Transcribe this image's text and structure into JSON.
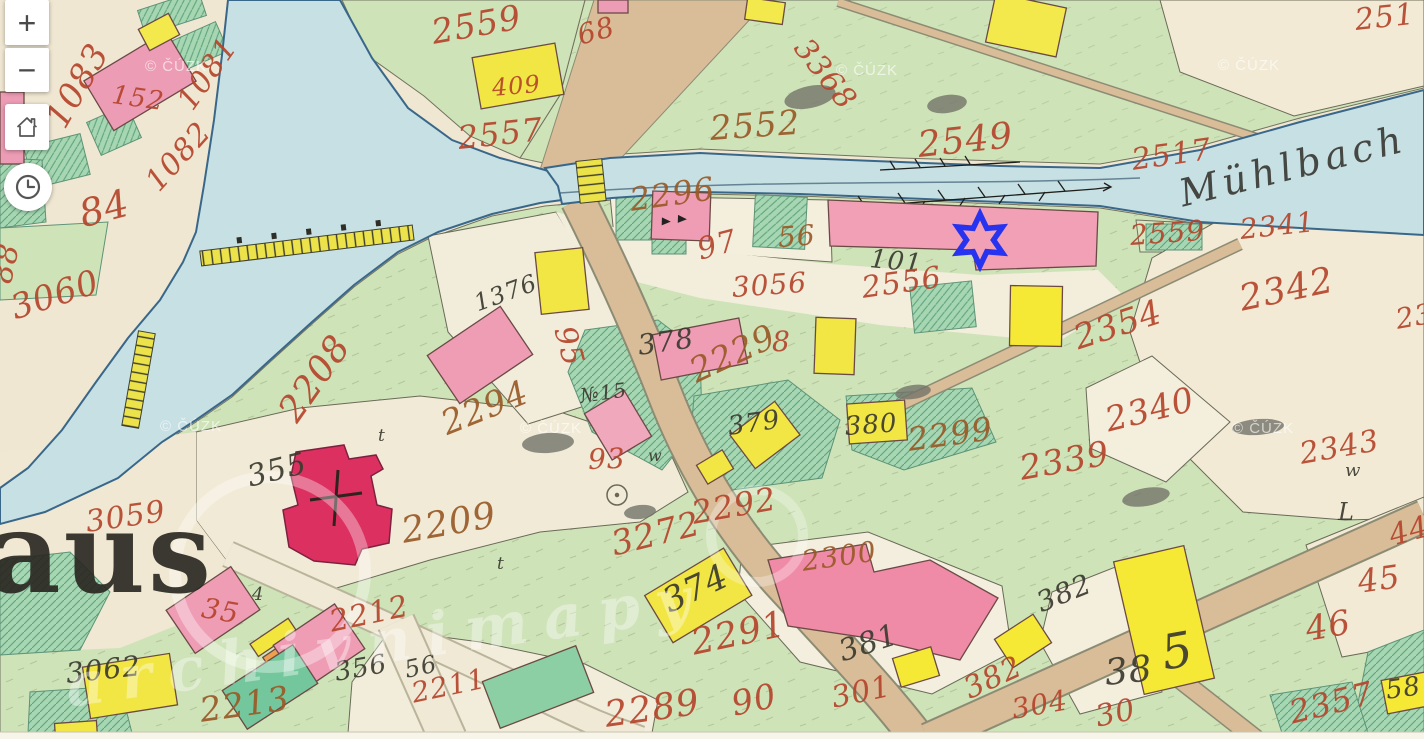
{
  "app": {
    "type": "historical-cadastral-map-viewer"
  },
  "controls": {
    "zoom_in": "+",
    "zoom_out": "−",
    "home_icon": "home",
    "history_icon": "clock"
  },
  "map": {
    "river_label": "Mühlbach",
    "place_name_fragment": "aus",
    "watermark_text": "© ČÚZK",
    "watermark_positions": [
      [
        145,
        58
      ],
      [
        836,
        62
      ],
      [
        1218,
        57
      ],
      [
        160,
        418
      ],
      [
        520,
        420
      ],
      [
        1232,
        420
      ]
    ],
    "diagonal_watermark": "archivnimapy",
    "marker": {
      "shape": "six-pointed-star",
      "color": "#2733ee",
      "x": 980,
      "y": 240
    },
    "colors": {
      "paper": "#efe7d2",
      "meadow": "#cfe3b8",
      "garden": "#a6d6b2",
      "water": "#c7e0e4",
      "road": "#d9bc98",
      "building_masonry": "#ef9db5",
      "building_church": "#dc3160",
      "building_wood": "#f1e643",
      "number_red": "#b5452c",
      "number_brown": "#9a5a28",
      "ink_black": "#3b3a30"
    },
    "parcel_labels": [
      {
        "t": "1083",
        "x": 55,
        "y": 108,
        "r": -60,
        "s": 34,
        "c": "red"
      },
      {
        "t": "152",
        "x": 112,
        "y": 82,
        "r": 8,
        "s": 26,
        "c": "red"
      },
      {
        "t": "1081",
        "x": 185,
        "y": 92,
        "r": -55,
        "s": 30,
        "c": "red"
      },
      {
        "t": "1082",
        "x": 152,
        "y": 172,
        "r": -48,
        "s": 30,
        "c": "red"
      },
      {
        "t": "84",
        "x": 80,
        "y": 196,
        "r": -15,
        "s": 38,
        "c": "red"
      },
      {
        "t": "88",
        "x": 2,
        "y": 268,
        "r": -78,
        "s": 30,
        "c": "red"
      },
      {
        "t": "3060",
        "x": 12,
        "y": 292,
        "r": -18,
        "s": 34,
        "c": "red"
      },
      {
        "t": "3059",
        "x": 86,
        "y": 508,
        "r": -8,
        "s": 30,
        "c": "red"
      },
      {
        "t": "2559",
        "x": 432,
        "y": 16,
        "r": -10,
        "s": 34,
        "c": "red"
      },
      {
        "t": "68",
        "x": 578,
        "y": 22,
        "r": -15,
        "s": 28,
        "c": "red"
      },
      {
        "t": "409",
        "x": 492,
        "y": 76,
        "r": -5,
        "s": 24,
        "c": "red"
      },
      {
        "t": "2557",
        "x": 458,
        "y": 122,
        "r": -6,
        "s": 32,
        "c": "red"
      },
      {
        "t": "2552",
        "x": 710,
        "y": 112,
        "r": -4,
        "s": 34,
        "c": "brown"
      },
      {
        "t": "3368",
        "x": 800,
        "y": 28,
        "r": 52,
        "s": 30,
        "c": "red"
      },
      {
        "t": "2549",
        "x": 918,
        "y": 128,
        "r": -6,
        "s": 36,
        "c": "red"
      },
      {
        "t": "251",
        "x": 1355,
        "y": 6,
        "r": -6,
        "s": 30,
        "c": "red"
      },
      {
        "t": "2517",
        "x": 1132,
        "y": 146,
        "r": -8,
        "s": 30,
        "c": "red"
      },
      {
        "t": "2296",
        "x": 630,
        "y": 184,
        "r": -8,
        "s": 32,
        "c": "brown"
      },
      {
        "t": "97",
        "x": 698,
        "y": 236,
        "r": -15,
        "s": 30,
        "c": "red"
      },
      {
        "t": "56",
        "x": 778,
        "y": 224,
        "r": -4,
        "s": 28,
        "c": "brown"
      },
      {
        "t": "101",
        "x": 870,
        "y": 246,
        "r": 6,
        "s": 26,
        "c": "black"
      },
      {
        "t": "3056",
        "x": 732,
        "y": 274,
        "r": -4,
        "s": 28,
        "c": "red"
      },
      {
        "t": "2556",
        "x": 862,
        "y": 274,
        "r": -8,
        "s": 30,
        "c": "red"
      },
      {
        "t": "2559",
        "x": 1130,
        "y": 222,
        "r": -4,
        "s": 28,
        "c": "red"
      },
      {
        "t": "2341",
        "x": 1240,
        "y": 216,
        "r": -6,
        "s": 28,
        "c": "red"
      },
      {
        "t": "2342",
        "x": 1240,
        "y": 282,
        "r": -12,
        "s": 36,
        "c": "red"
      },
      {
        "t": "23",
        "x": 1396,
        "y": 306,
        "r": -10,
        "s": 28,
        "c": "red"
      },
      {
        "t": "2354",
        "x": 1075,
        "y": 322,
        "r": -18,
        "s": 34,
        "c": "red"
      },
      {
        "t": "2340",
        "x": 1106,
        "y": 404,
        "r": -14,
        "s": 34,
        "c": "red"
      },
      {
        "t": "2339",
        "x": 1020,
        "y": 452,
        "r": -10,
        "s": 34,
        "c": "red"
      },
      {
        "t": "2343",
        "x": 1300,
        "y": 440,
        "r": -10,
        "s": 30,
        "c": "red"
      },
      {
        "t": "w",
        "x": 1345,
        "y": 462,
        "r": 0,
        "s": 18,
        "c": "black"
      },
      {
        "t": "1376",
        "x": 475,
        "y": 292,
        "r": -20,
        "s": 24,
        "c": "black"
      },
      {
        "t": "95",
        "x": 563,
        "y": 312,
        "r": 75,
        "s": 30,
        "c": "red"
      },
      {
        "t": "2208",
        "x": 288,
        "y": 400,
        "r": -55,
        "s": 36,
        "c": "red"
      },
      {
        "t": "2294",
        "x": 443,
        "y": 408,
        "r": -22,
        "s": 34,
        "c": "brown"
      },
      {
        "t": "№15",
        "x": 580,
        "y": 386,
        "r": -8,
        "s": 20,
        "c": "black"
      },
      {
        "t": "355",
        "x": 248,
        "y": 463,
        "r": -14,
        "s": 30,
        "c": "black"
      },
      {
        "t": "2209",
        "x": 402,
        "y": 514,
        "r": -10,
        "s": 36,
        "c": "brown"
      },
      {
        "t": "t",
        "x": 378,
        "y": 428,
        "r": 0,
        "s": 17,
        "c": "black"
      },
      {
        "t": "t",
        "x": 497,
        "y": 556,
        "r": 0,
        "s": 17,
        "c": "black"
      },
      {
        "t": "378",
        "x": 638,
        "y": 332,
        "r": -8,
        "s": 28,
        "c": "black"
      },
      {
        "t": "2229",
        "x": 692,
        "y": 356,
        "r": -25,
        "s": 34,
        "c": "brown"
      },
      {
        "t": "8",
        "x": 772,
        "y": 328,
        "r": 0,
        "s": 28,
        "c": "red"
      },
      {
        "t": "93",
        "x": 588,
        "y": 446,
        "r": -2,
        "s": 28,
        "c": "red"
      },
      {
        "t": "w",
        "x": 648,
        "y": 448,
        "r": 0,
        "s": 16,
        "c": "black"
      },
      {
        "t": "379",
        "x": 728,
        "y": 414,
        "r": -8,
        "s": 26,
        "c": "black"
      },
      {
        "t": "380",
        "x": 845,
        "y": 414,
        "r": -4,
        "s": 26,
        "c": "black"
      },
      {
        "t": "2299",
        "x": 908,
        "y": 424,
        "r": -8,
        "s": 32,
        "c": "brown"
      },
      {
        "t": "2292",
        "x": 692,
        "y": 497,
        "r": -10,
        "s": 32,
        "c": "red"
      },
      {
        "t": "3272",
        "x": 612,
        "y": 528,
        "r": -14,
        "s": 34,
        "c": "red"
      },
      {
        "t": "2300",
        "x": 802,
        "y": 548,
        "r": -8,
        "s": 28,
        "c": "brown"
      },
      {
        "t": "374",
        "x": 665,
        "y": 586,
        "r": -25,
        "s": 34,
        "c": "black"
      },
      {
        "t": "2291",
        "x": 692,
        "y": 626,
        "r": -12,
        "s": 36,
        "c": "red"
      },
      {
        "t": "381",
        "x": 840,
        "y": 638,
        "r": -18,
        "s": 30,
        "c": "black"
      },
      {
        "t": "90",
        "x": 732,
        "y": 688,
        "r": -12,
        "s": 34,
        "c": "red"
      },
      {
        "t": "301",
        "x": 832,
        "y": 684,
        "r": -12,
        "s": 30,
        "c": "red"
      },
      {
        "t": "2289",
        "x": 605,
        "y": 698,
        "r": -8,
        "s": 36,
        "c": "red"
      },
      {
        "t": "382",
        "x": 1038,
        "y": 590,
        "r": -22,
        "s": 28,
        "c": "black"
      },
      {
        "t": "38",
        "x": 1105,
        "y": 656,
        "r": -6,
        "s": 36,
        "c": "black"
      },
      {
        "t": "5",
        "x": 1162,
        "y": 630,
        "r": -10,
        "s": 48,
        "c": "black"
      },
      {
        "t": "382",
        "x": 966,
        "y": 676,
        "r": -25,
        "s": 30,
        "c": "red"
      },
      {
        "t": "304",
        "x": 1012,
        "y": 696,
        "r": -10,
        "s": 28,
        "c": "red"
      },
      {
        "t": "30",
        "x": 1096,
        "y": 703,
        "r": -12,
        "s": 30,
        "c": "red"
      },
      {
        "t": "44",
        "x": 1390,
        "y": 522,
        "r": -15,
        "s": 30,
        "c": "red"
      },
      {
        "t": "45",
        "x": 1358,
        "y": 566,
        "r": -8,
        "s": 32,
        "c": "red"
      },
      {
        "t": "46",
        "x": 1306,
        "y": 613,
        "r": -10,
        "s": 34,
        "c": "red"
      },
      {
        "t": "2357",
        "x": 1290,
        "y": 697,
        "r": -14,
        "s": 32,
        "c": "red"
      },
      {
        "t": "58",
        "x": 1386,
        "y": 678,
        "r": -8,
        "s": 26,
        "c": "black"
      },
      {
        "t": "L",
        "x": 1338,
        "y": 500,
        "r": 0,
        "s": 24,
        "c": "black"
      },
      {
        "t": "35",
        "x": 202,
        "y": 594,
        "r": 10,
        "s": 28,
        "c": "red"
      },
      {
        "t": "4",
        "x": 252,
        "y": 586,
        "r": 0,
        "s": 18,
        "c": "black"
      },
      {
        "t": "2212",
        "x": 330,
        "y": 608,
        "r": -12,
        "s": 30,
        "c": "red"
      },
      {
        "t": "3062",
        "x": 66,
        "y": 660,
        "r": -6,
        "s": 28,
        "c": "black"
      },
      {
        "t": "356",
        "x": 335,
        "y": 660,
        "r": -10,
        "s": 26,
        "c": "black"
      },
      {
        "t": "56",
        "x": 405,
        "y": 658,
        "r": -12,
        "s": 24,
        "c": "black"
      },
      {
        "t": "2213",
        "x": 200,
        "y": 694,
        "r": -8,
        "s": 34,
        "c": "brown"
      },
      {
        "t": "2211",
        "x": 412,
        "y": 680,
        "r": -12,
        "s": 28,
        "c": "red"
      }
    ]
  }
}
